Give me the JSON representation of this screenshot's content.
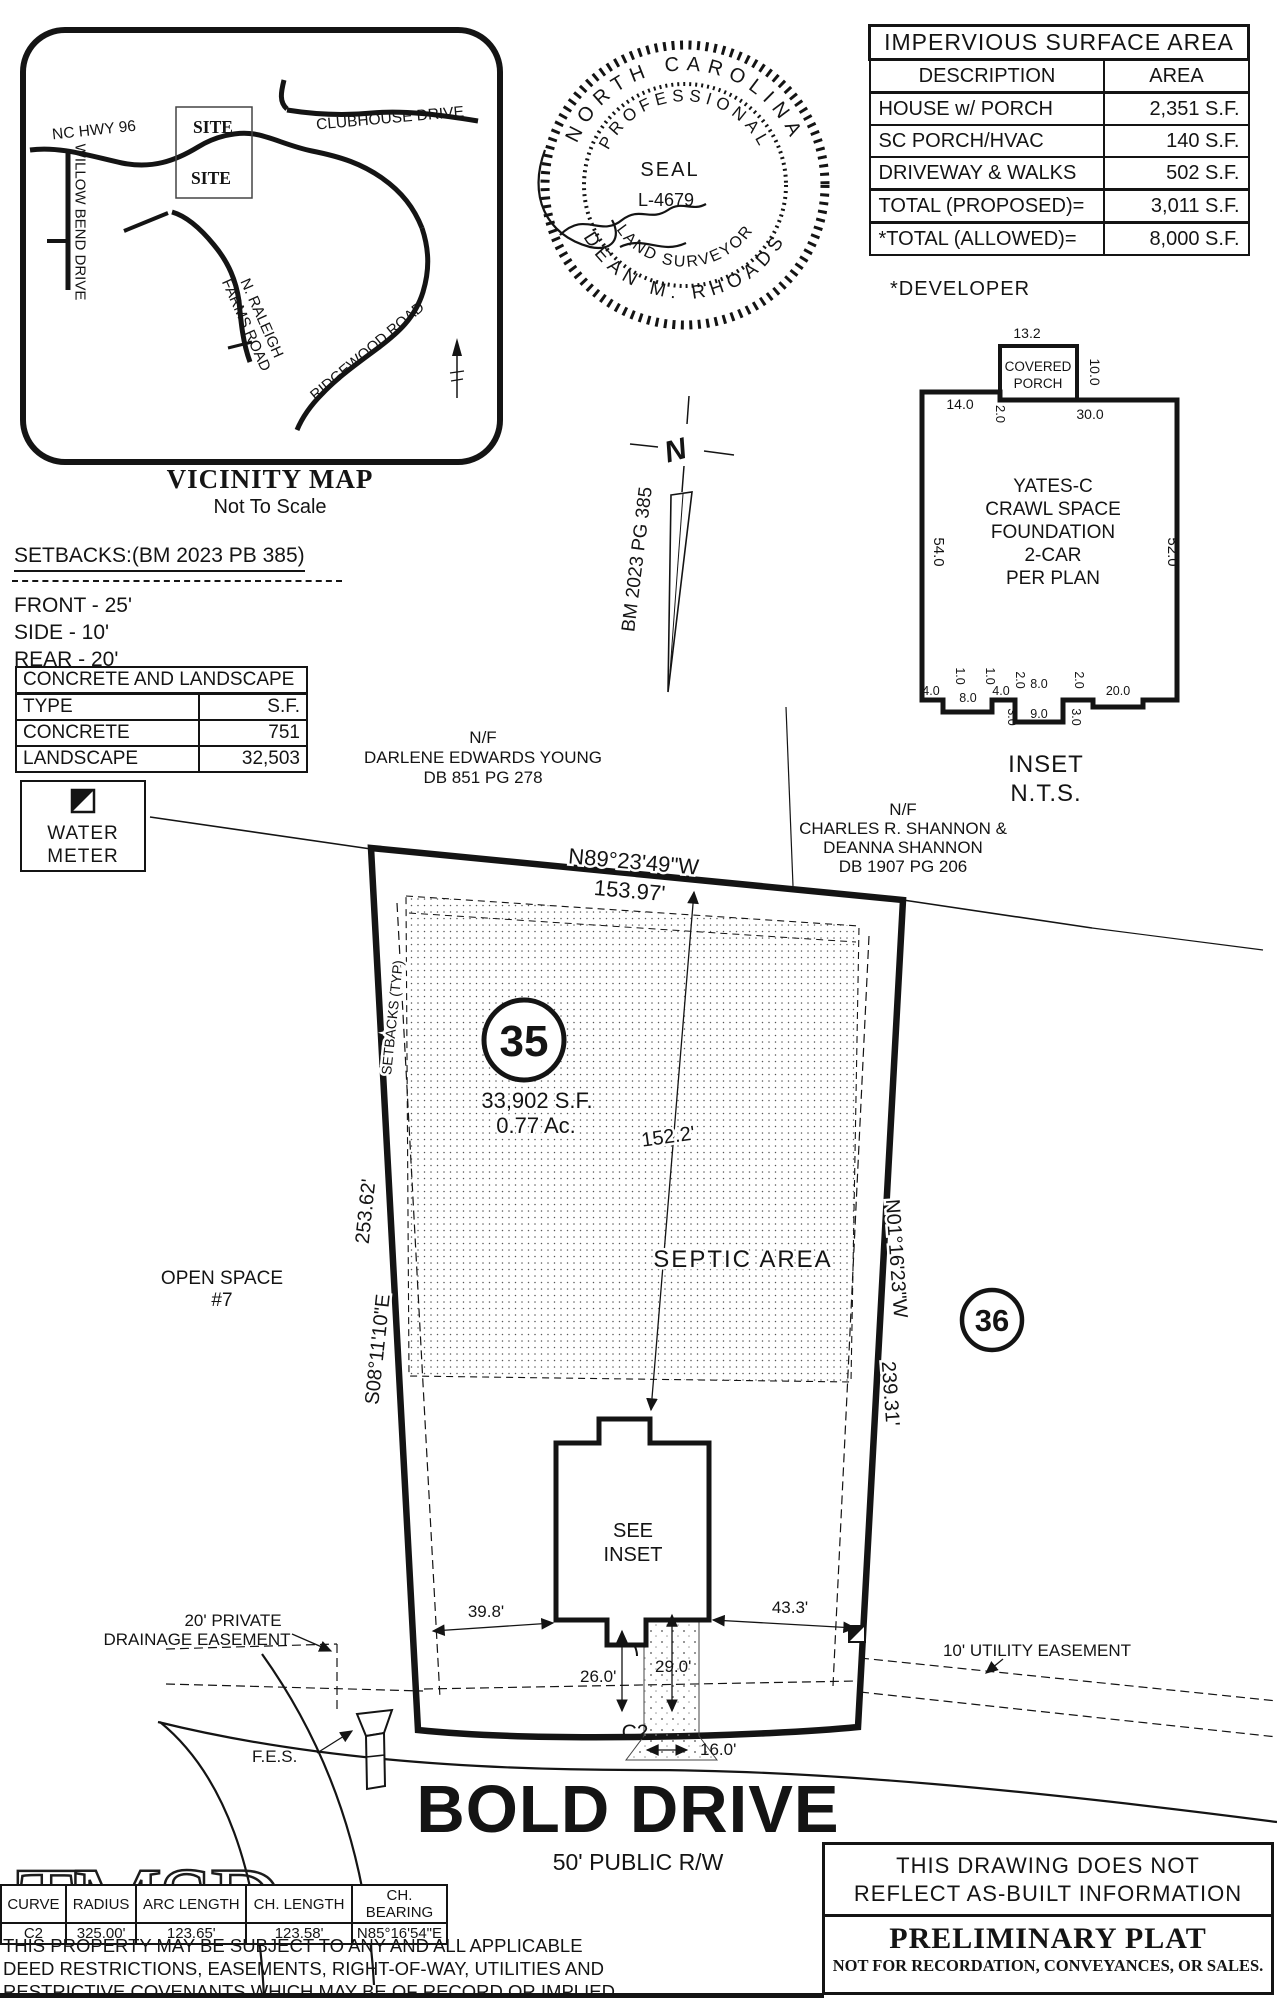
{
  "page": {
    "paper": "#ffffff",
    "ink": "#141414"
  },
  "vicinity": {
    "title": "VICINITY MAP",
    "subtitle": "Not To Scale",
    "site_label": "SITE",
    "site_label_2": "SITE",
    "roads": {
      "hwy96": "NC HWY 96",
      "willow_bend": "WILLOW BEND DRIVE",
      "clubhouse": "CLUBHOUSE DRIVE",
      "raleigh_farms_1": "N. RALEIGH",
      "raleigh_farms_2": "FARMS ROAD",
      "ridgewood": "RIDGEWOOD ROAD"
    }
  },
  "seal": {
    "arc_top": "NORTH CAROLINA",
    "arc_inner_top": "PROFESSIONAL",
    "center_1": "SEAL",
    "center_2": "L-4679",
    "arc_inner_bottom": "LAND SURVEYOR",
    "arc_bottom": "DEAN M. RHOADS"
  },
  "impervious": {
    "title": "IMPERVIOUS SURFACE AREA",
    "col_desc": "DESCRIPTION",
    "col_area": "AREA",
    "rows": [
      [
        "HOUSE w/ PORCH",
        "2,351 S.F."
      ],
      [
        "SC PORCH/HVAC",
        "140 S.F."
      ],
      [
        "DRIVEWAY & WALKS",
        "502 S.F."
      ],
      [
        "TOTAL (PROPOSED)=",
        "3,011 S.F."
      ],
      [
        "*TOTAL (ALLOWED)=",
        "8,000 S.F."
      ]
    ],
    "footnote": "*DEVELOPER"
  },
  "inset_house": {
    "label": "INSET",
    "scale": "N.T.S.",
    "name_lines": [
      "YATES-C",
      "CRAWL SPACE",
      "FOUNDATION",
      "2-CAR",
      "PER PLAN"
    ],
    "porch_line1": "COVERED",
    "porch_line2": "PORCH",
    "dims": {
      "porch_top": "13.2",
      "porch_right": "10.0",
      "top_left": "14.0",
      "porch_offset": "2.0",
      "top_right": "30.0",
      "side_left": "54.0",
      "side_right": "52.0",
      "b1": "4.0",
      "b2": "1.0",
      "b3": "8.0",
      "b4": "1.0",
      "b5": "4.0",
      "b6": "2.0",
      "b7": "8.0",
      "b8": "2.0",
      "b9": "20.0",
      "stoop_w": "9.0",
      "s1": "3.0",
      "s2": "3.0"
    }
  },
  "north_arrow": {
    "n": "N",
    "ref": "BM 2023 PG 385"
  },
  "setbacks": {
    "heading": "SETBACKS:(BM 2023 PB 385)",
    "front": "FRONT - 25'",
    "side": "SIDE - 10'",
    "rear": "REAR - 20'"
  },
  "concrete": {
    "title": "CONCRETE AND LANDSCAPE",
    "col_type": "TYPE",
    "col_sf": "S.F.",
    "rows": [
      [
        "CONCRETE",
        "751"
      ],
      [
        "LANDSCAPE",
        "32,503"
      ]
    ]
  },
  "legend": {
    "water_1": "WATER",
    "water_2": "METER"
  },
  "neighbors": {
    "young": [
      "N/F",
      "DARLENE EDWARDS YOUNG",
      "DB 851 PG 278"
    ],
    "shannon": [
      "N/F",
      "CHARLES R. SHANNON &",
      "DEANNA SHANNON",
      "DB 1907 PG 206"
    ]
  },
  "lot": {
    "number": "35",
    "area_sf": "33,902 S.F.",
    "area_ac": "0.77 Ac.",
    "septic": "SEPTIC AREA",
    "setback_typ": "SETBACKS (TYP)",
    "open_space_1": "OPEN SPACE",
    "open_space_2": "#7",
    "adjacent": "36",
    "see_1": "SEE",
    "see_2": "INSET",
    "bearing_top": "N89°23'49\"W",
    "dist_top": "153.97'",
    "bearing_left": "S08°11'10\"E",
    "dist_left": "253.62'",
    "bearing_right": "N01°16'23\"W",
    "dist_right": "239.31'",
    "dim_house": "152.2'",
    "dim_left": "39.8'",
    "dim_right": "43.3'",
    "dim_drive_1": "26.0'",
    "dim_drive_2": "29.0'",
    "dim_drive_w": "16.0'",
    "curve": "C2",
    "fes": "F.E.S."
  },
  "easements": {
    "drainage_1": "20' PRIVATE",
    "drainage_2": "DRAINAGE EASEMENT",
    "utility": "10' UTILITY EASEMENT"
  },
  "road": {
    "name": "BOLD DRIVE",
    "rw": "50' PUBLIC R/W"
  },
  "curve_table": {
    "headers": [
      "CURVE",
      "RADIUS",
      "ARC LENGTH",
      "CH. LENGTH",
      "CH. BEARING"
    ],
    "rows": [
      [
        "C2",
        "325.00'",
        "123.65'",
        "123.58'",
        "N85°16'54\"E"
      ]
    ]
  },
  "watermark": "TMSD",
  "disclaimer": [
    "THIS PROPERTY MAY BE SUBJECT TO ANY AND ALL APPLICABLE",
    "DEED RESTRICTIONS, EASEMENTS, RIGHT-OF-WAY, UTILITIES AND",
    "RESTRICTIVE COVENANTS WHICH MAY BE OF RECORD OR IMPLIED"
  ],
  "notice": {
    "line_1": "THIS DRAWING DOES NOT",
    "line_2": "REFLECT AS-BUILT INFORMATION",
    "title": "PRELIMINARY PLAT",
    "subtitle": "NOT FOR RECORDATION, CONVEYANCES, OR SALES."
  }
}
